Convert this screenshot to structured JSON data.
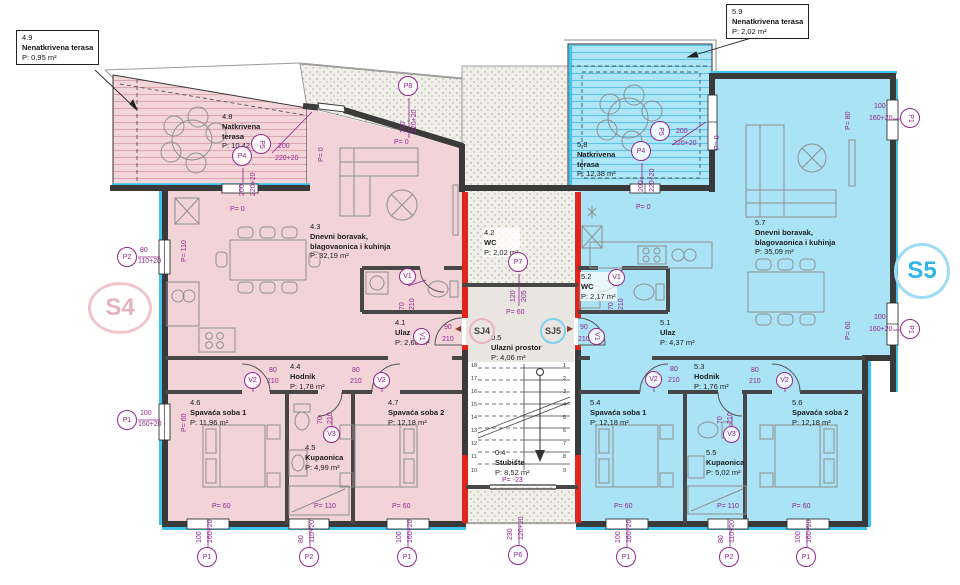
{
  "units": {
    "s4": "S4",
    "s5": "S5"
  },
  "junctions": {
    "sj4": "SJ4",
    "sj5": "SJ5"
  },
  "callouts": {
    "c49": {
      "num": "4.9",
      "name": "Nenatkrivena terasa",
      "area": "P: 0,95 m²"
    },
    "c59": {
      "num": "5.9",
      "name": "Nenatkrivena terasa",
      "area": "P: 2,02 m²"
    }
  },
  "rooms": {
    "r41": {
      "num": "4.1",
      "name": "Ulaz",
      "area": "P: 2,68 m²"
    },
    "r42": {
      "num": "4.2",
      "name": "WC",
      "area": "P: 2,02 m²"
    },
    "r43": {
      "num": "4.3",
      "name": "Dnevni boravak,",
      "name2": "blagovaonica i kuhinja",
      "area": "P: 32,19 m²"
    },
    "r44": {
      "num": "4.4",
      "name": "Hodnik",
      "area": "P: 1,78 m²"
    },
    "r45": {
      "num": "4.5",
      "name": "Kupaonica",
      "area": "P: 4,99 m²"
    },
    "r46": {
      "num": "4.6",
      "name": "Spavaća soba 1",
      "area": "P: 11,96 m²"
    },
    "r47": {
      "num": "4.7",
      "name": "Spavaća soba 2",
      "area": "P: 12,18 m²"
    },
    "r48": {
      "num": "4.8",
      "name": "Natkrivena",
      "name2": "terasa",
      "area": "P: 10,42 m²"
    },
    "r51": {
      "num": "5.1",
      "name": "Ulaz",
      "area": "P: 4,37 m²"
    },
    "r52": {
      "num": "5.2",
      "name": "WC",
      "area": "P: 2,17 m²"
    },
    "r53": {
      "num": "5.3",
      "name": "Hodnik",
      "area": "P: 1,76 m²"
    },
    "r54": {
      "num": "5.4",
      "name": "Spavaća soba 1",
      "area": "P: 12,18 m²"
    },
    "r55": {
      "num": "5.5",
      "name": "Kupaonica",
      "area": "P: 5,02 m²"
    },
    "r56": {
      "num": "5.6",
      "name": "Spavaća soba 2",
      "area": "P: 12,18 m²"
    },
    "r57": {
      "num": "5.7",
      "name": "Dnevni boravak,",
      "name2": "blagovaonica i kuhinja",
      "area": "P: 35,09 m²"
    },
    "r58": {
      "num": "5.8",
      "name": "Natkrivena",
      "name2": "terasa",
      "area": "P: 12,38 m²"
    },
    "r04": {
      "num": "0.4",
      "name": "Stubište",
      "area": "P: 8,52 m²"
    },
    "r05": {
      "num": "0.5",
      "name": "Ulazni prostor",
      "area": "P: 4,06 m²"
    }
  },
  "levels": {
    "p0": "P= 0",
    "p60": "P= 60",
    "p80": "P= 80",
    "p110": "P= 110",
    "pm23": "P= -23"
  },
  "dims": {
    "d70": "70",
    "d80": "80",
    "d90": "90",
    "d100": "100",
    "d120": "120",
    "d200": "200",
    "d205": "205",
    "d210": "210",
    "d230": "230",
    "w110": "110+20",
    "w120": "120+20",
    "w160": "160+20",
    "w220": "220+20"
  },
  "marks": {
    "p1": "P1",
    "p2": "P2",
    "p4": "P4",
    "p5": "P5",
    "p6": "P6",
    "p7": "P7",
    "p8": "P8",
    "v1": "V1",
    "v2": "V2",
    "v3": "V3"
  },
  "stairs": {
    "left": [
      "18",
      "17",
      "16",
      "15",
      "14",
      "13",
      "12",
      "11",
      "10"
    ],
    "right": [
      "1",
      "2",
      "3",
      "4",
      "5",
      "6",
      "7",
      "8",
      "9"
    ]
  },
  "colors": {
    "s4_fill": "#f2d3d8",
    "s5_fill": "#a9e3f5",
    "red_wall": "#e1251b",
    "insulation": "#3ec3ef",
    "annotation": "#93278f"
  }
}
